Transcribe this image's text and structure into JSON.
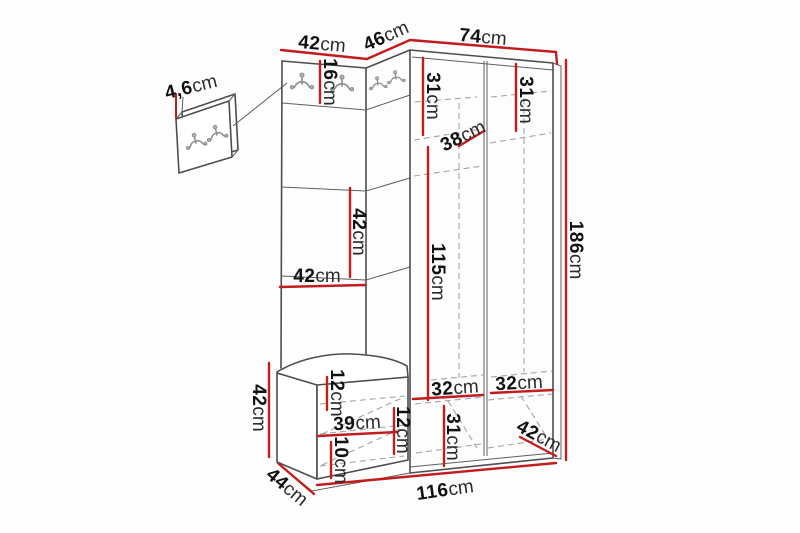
{
  "page": {
    "background": "#fdfdfd"
  },
  "colors": {
    "dimension_red": "#c41c1c",
    "outline_gray": "#4d4d4d",
    "hidden_edge_gray": "#a3a3a3",
    "hook_gray": "#8d8d8d",
    "label_text": "#111111"
  },
  "icons": {
    "coat_hook": "coat-hook-icon"
  },
  "detail_callout": {
    "thickness": {
      "value": "4,6",
      "unit": "cm"
    }
  },
  "dimensions": {
    "top_width": {
      "value": "42",
      "unit": "cm"
    },
    "corner_width": {
      "value": "46",
      "unit": "cm"
    },
    "wardrobe_width": {
      "value": "74",
      "unit": "cm"
    },
    "hook_strip_height": {
      "value": "16",
      "unit": "cm"
    },
    "left_top_shelf_height": {
      "value": "31",
      "unit": "cm"
    },
    "shelf_depth": {
      "value": "38",
      "unit": "cm"
    },
    "right_top_shelf_height": {
      "value": "31",
      "unit": "cm"
    },
    "total_height": {
      "value": "186",
      "unit": "cm"
    },
    "panel_segment_height": {
      "value": "42",
      "unit": "cm"
    },
    "panel_width": {
      "value": "42",
      "unit": "cm"
    },
    "hanging_space_height": {
      "value": "115",
      "unit": "cm"
    },
    "bench_height": {
      "value": "42",
      "unit": "cm"
    },
    "bench_top_inset": {
      "value": "12",
      "unit": "cm"
    },
    "bench_inner_width": {
      "value": "39",
      "unit": "cm"
    },
    "bench_right_inset": {
      "value": "12",
      "unit": "cm"
    },
    "bench_shelf_gap": {
      "value": "10",
      "unit": "cm"
    },
    "bench_depth": {
      "value": "44",
      "unit": "cm"
    },
    "left_compartment_width": {
      "value": "32",
      "unit": "cm"
    },
    "right_compartment_width": {
      "value": "32",
      "unit": "cm"
    },
    "bottom_compartment_height": {
      "value": "31",
      "unit": "cm"
    },
    "wardrobe_depth": {
      "value": "42",
      "unit": "cm"
    },
    "total_width": {
      "value": "116",
      "unit": "cm"
    }
  }
}
